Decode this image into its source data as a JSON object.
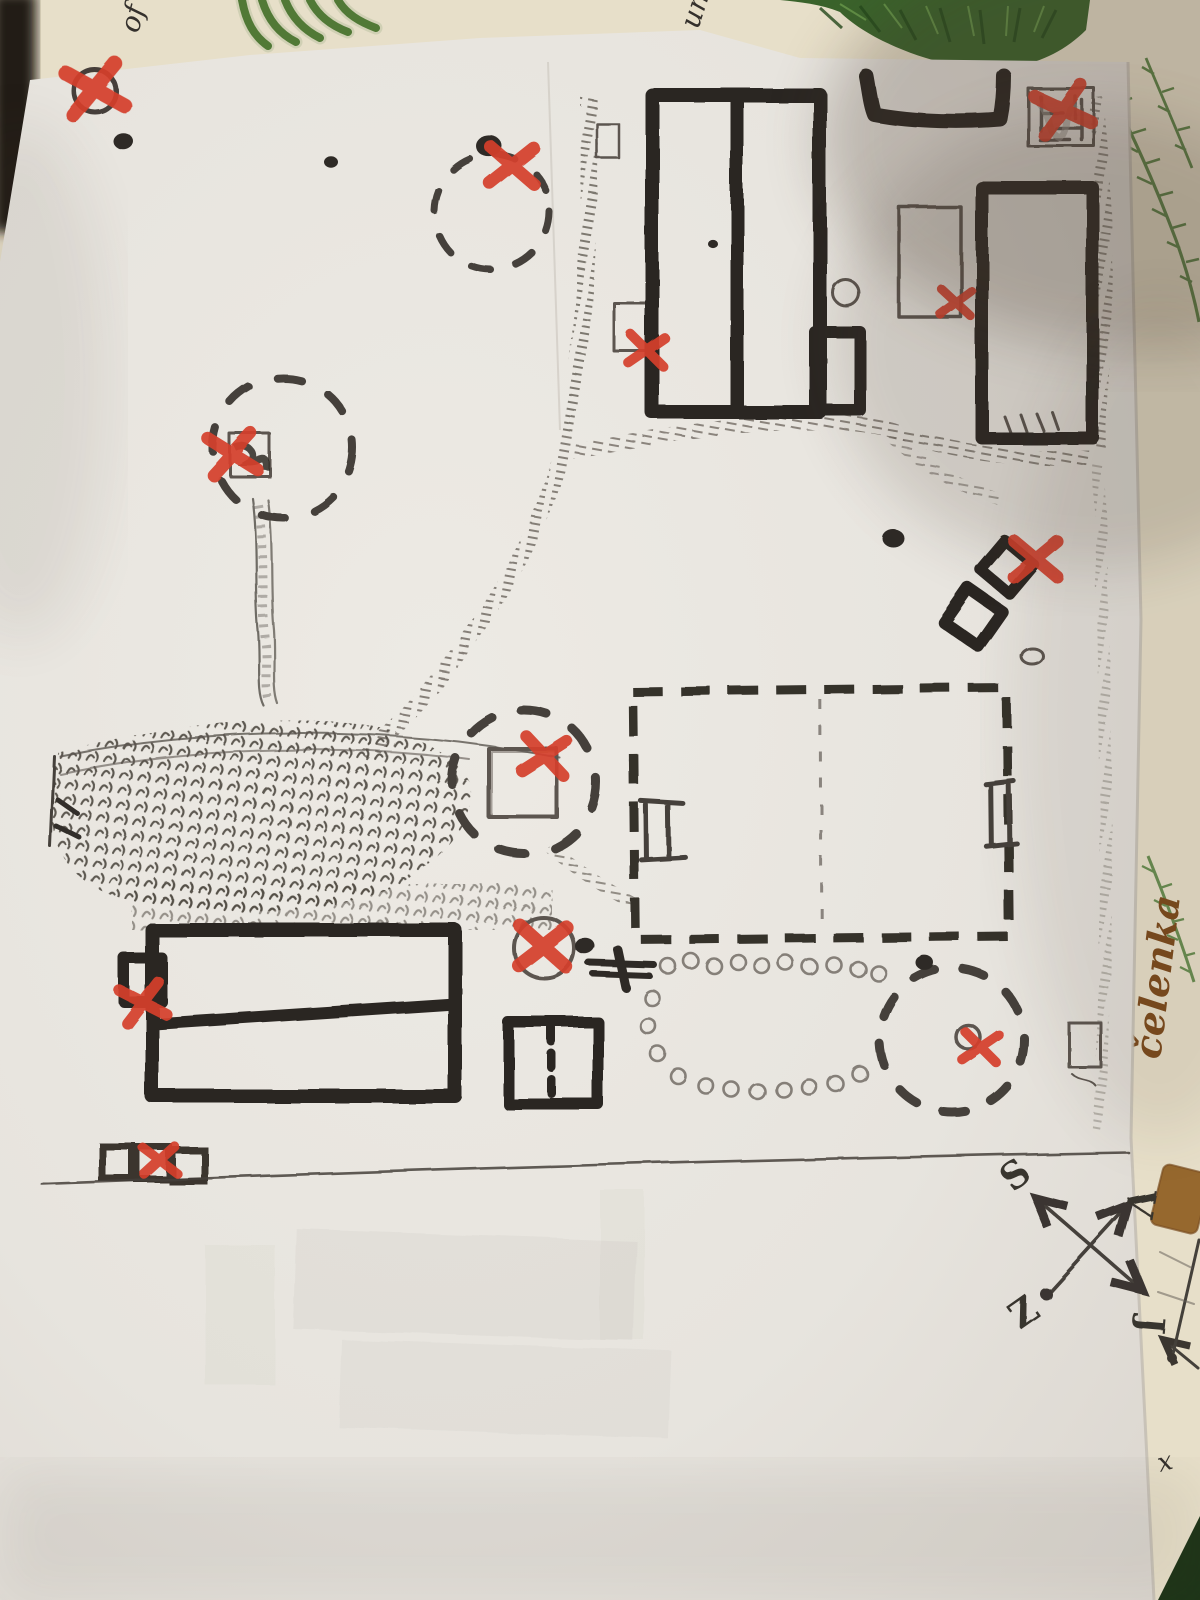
{
  "scene": {
    "kind": "photo of a hand-drawn map on paper",
    "paper_color": "#e9e6e0",
    "undersheet_color": "#e7dfc9",
    "ink_color": "#2b2622",
    "pencil_color": "#5b5550",
    "marker_red": "#d4402c",
    "foliage_green": "#436c2e",
    "tape_brown": "#96682e"
  },
  "handwriting": {
    "top_left": "of",
    "top_center": "un",
    "right_label": "čelenka",
    "corner_letter": "x"
  },
  "compass": {
    "north": "S",
    "east": "V",
    "west": "Z",
    "south": "J"
  },
  "map": {
    "x_marks": [
      {
        "name": "circled-mark-top-left",
        "x": 95,
        "y": 90,
        "size": 27,
        "rot": -8
      },
      {
        "name": "dashed-circle-top",
        "x": 512,
        "y": 166,
        "size": 23,
        "rot": 4
      },
      {
        "name": "building-top-middle",
        "x": 647,
        "y": 351,
        "size": 18,
        "rot": 8
      },
      {
        "name": "hatched-square-top-right",
        "x": 1063,
        "y": 110,
        "size": 25,
        "rot": -12
      },
      {
        "name": "pencil-rect-right",
        "x": 956,
        "y": 303,
        "size": 16,
        "rot": 6
      },
      {
        "name": "diamonds-right",
        "x": 1036,
        "y": 560,
        "size": 23,
        "rot": 3
      },
      {
        "name": "center-square",
        "x": 545,
        "y": 757,
        "size": 22,
        "rot": 10
      },
      {
        "name": "octagon-left",
        "x": 233,
        "y": 455,
        "size": 23,
        "rot": -5
      },
      {
        "name": "circle-mid",
        "x": 543,
        "y": 947,
        "size": 25,
        "rot": 5
      },
      {
        "name": "left-building-annex",
        "x": 143,
        "y": 1003,
        "size": 21,
        "rot": -10
      },
      {
        "name": "bottom-right-circle",
        "x": 980,
        "y": 1047,
        "size": 18,
        "rot": 8
      },
      {
        "name": "squares-bottom-left",
        "x": 160,
        "y": 1161,
        "size": 17,
        "rot": 0
      }
    ],
    "stones": [
      [
        668,
        966
      ],
      [
        691,
        961
      ],
      [
        714,
        966
      ],
      [
        738,
        962
      ],
      [
        762,
        966
      ],
      [
        786,
        963
      ],
      [
        810,
        967
      ],
      [
        834,
        965
      ],
      [
        858,
        969
      ],
      [
        878,
        973
      ],
      [
        652,
        998
      ],
      [
        648,
        1026
      ],
      [
        658,
        1054
      ],
      [
        678,
        1076
      ],
      [
        706,
        1086
      ],
      [
        732,
        1090
      ],
      [
        758,
        1092
      ],
      [
        784,
        1090
      ],
      [
        810,
        1088
      ],
      [
        836,
        1084
      ],
      [
        860,
        1074
      ]
    ],
    "ink_dots": [
      [
        123,
        141,
        10
      ],
      [
        331,
        162,
        7
      ],
      [
        489,
        146,
        13
      ],
      [
        712,
        243,
        5
      ],
      [
        893,
        538,
        11
      ],
      [
        925,
        963,
        9
      ],
      [
        585,
        946,
        10
      ]
    ]
  }
}
